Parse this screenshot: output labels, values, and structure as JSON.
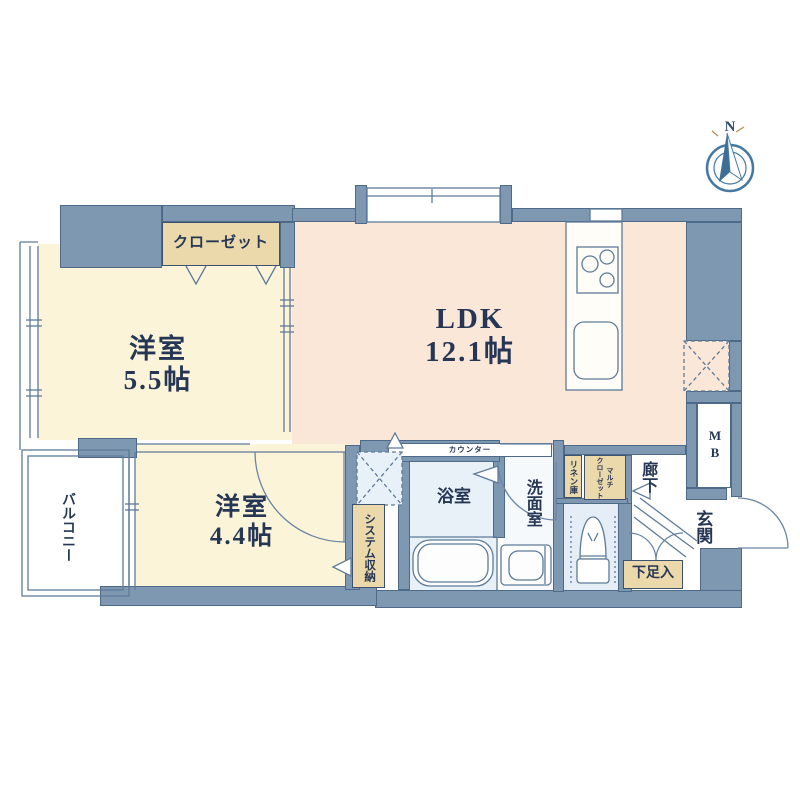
{
  "compass": {
    "north": "N"
  },
  "rooms": {
    "bedroom1": {
      "name": "洋室",
      "size": "5.5帖"
    },
    "ldk": {
      "name": "LDK",
      "size": "12.1帖"
    },
    "bedroom2": {
      "name": "洋室",
      "size": "4.4帖"
    },
    "bathroom": {
      "label": "浴室"
    },
    "washroom": {
      "label": "洗面室"
    },
    "hallway": {
      "label": "廊下"
    },
    "entrance": {
      "label": "玄関"
    },
    "balcony": {
      "label": "バルコニー"
    }
  },
  "storage": {
    "closet": "クローゼット",
    "system_storage": "システム収納",
    "linen": "リネン庫",
    "multi_closet_line1": "マルチ",
    "multi_closet_line2": "クローゼット",
    "shoe_cabinet": "下足入",
    "meter_box": "MB"
  },
  "kitchen": {
    "counter": "カウンター"
  },
  "colors": {
    "wall": "#7f98b2",
    "wallline": "#4e6a89",
    "cream": "#fcf4d8",
    "peach": "#fbe7d8",
    "tan": "#ebd9ab",
    "wet": "#e9f1f8",
    "wet2": "#e5edf6",
    "navy": "#263755",
    "line": "#5e7b99",
    "compass": "#4678a0"
  }
}
